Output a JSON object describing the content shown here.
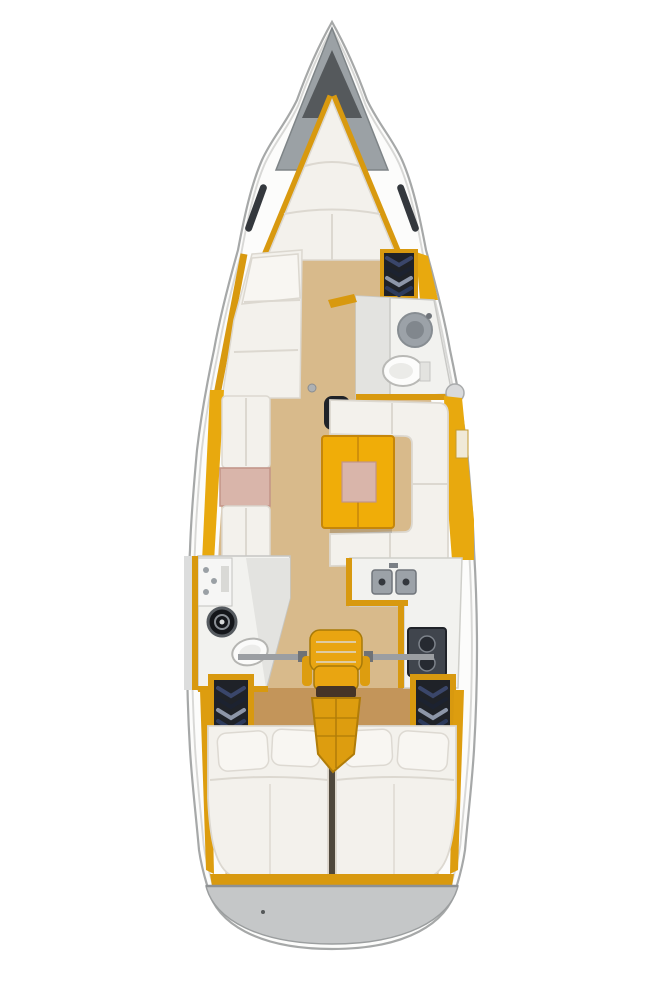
{
  "figure": {
    "type": "diagram",
    "subject": "sailboat-interior-floor-plan",
    "orientation": "bow-up",
    "regions": [
      "anchor-locker",
      "v-berth-forward-cabin",
      "port-forward-lounge",
      "forward-wardrobe",
      "forward-head-with-sink-and-toilet",
      "saloon-port-facing-settees",
      "saloon-table",
      "saloon-u-settee",
      "galley-double-sink",
      "galley-stove",
      "aft-head-with-toilet-and-sink",
      "companionway-seat-and-steps",
      "port-aft-locker",
      "starboard-aft-locker",
      "port-aft-double-berth",
      "starboard-aft-double-berth",
      "stern-transom"
    ]
  },
  "palette": {
    "hull_fill": "#fcfcfb",
    "hull_stroke": "#a6a8a8",
    "inner_line": "#d8d8d6",
    "deck_gray": "#9ba1a5",
    "anchor_dark": "#55595c",
    "trim": "#d8990f",
    "cabinet": "#e8a90e",
    "table_orange": "#f0ad08",
    "seat_orange": "#e9a511",
    "steps_orange": "#dd9d0f",
    "wood": "#d8ba8b",
    "wood_dark": "#c3955a",
    "cushion": "#f3f1ec",
    "pink": "#d9b5aa",
    "room_white": "#f2f2ef",
    "shower_gray": "#e3e3e0",
    "dark_unit": "#1f2228",
    "sink_gray": "#9ca2a8",
    "stove_dark": "#40454d",
    "burner_dark": "#262a31",
    "window_dark": "#34383d",
    "black_sink": "#14161a",
    "divider_brown": "#4f483c",
    "seat_band": "#463427",
    "transom": "#c5c7c8",
    "transom_edge": "#8e9193",
    "rail_gray": "#9b9ea2"
  }
}
